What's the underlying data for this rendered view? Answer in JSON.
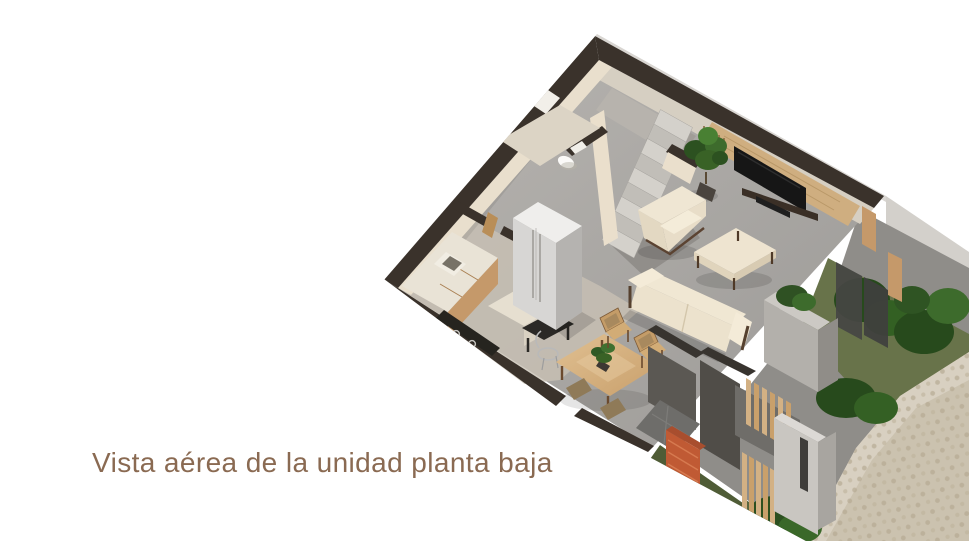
{
  "caption": {
    "text": "Vista aérea de la unidad planta baja",
    "color": "#8a6a52"
  },
  "render": {
    "alt": "Aerial 3D cutaway render of the ground-floor unit: kitchen with fridge and counters, bathroom with toilet, staircase, living room with sofa, armchair, coffee table and TV wall, dining table with chairs, entry patio with terracotta accent wall, wood slat screens, planters, bushes and cobblestone driveway",
    "palette": {
      "wall_dark": "#3a322b",
      "wall_cream": "#eadfcc",
      "floor_gray": "#a8a5a1",
      "floor_light": "#c8c1b4",
      "wood": "#c5996a",
      "wood_light": "#d3b184",
      "tv_black": "#161616",
      "sofa_cream": "#ece2cd",
      "plant_green": "#396226",
      "plant_dark": "#274a1c",
      "terracotta": "#c05a34",
      "concrete_gray": "#8f8d89",
      "paver_beige": "#cbc2af",
      "grass_green": "#68734a",
      "steel_gray": "#d7d6d4"
    }
  }
}
